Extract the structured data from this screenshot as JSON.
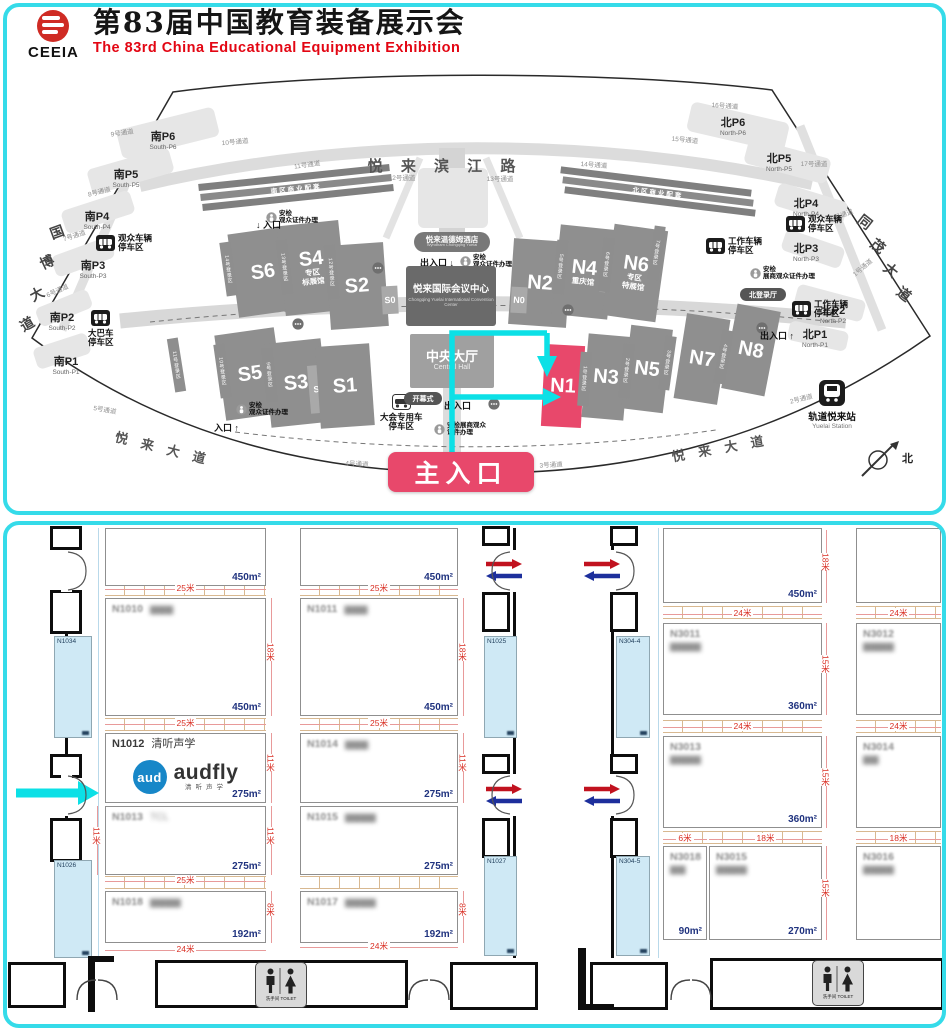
{
  "header": {
    "logo_text": "CEEIA",
    "title_cn": "第83届中国教育装备展示会",
    "title_en": "The 83rd China Educational Equipment Exhibition"
  },
  "colors": {
    "frame": "#35dbe9",
    "cyan": "#0ce0e6",
    "highlight": "#e8486b",
    "dim_red": "#d93025",
    "area_navy": "#20337f",
    "logo_blue": "#1787c8",
    "arrow_red": "#c1121f",
    "arrow_blue": "#1d2f9c",
    "hall_gray": "#8f8f8f"
  },
  "map": {
    "badge": "主入口",
    "north": "北",
    "roads_big": [
      {
        "t": "悦 来 滨 江 路",
        "x": 445,
        "y": 155,
        "fs": 15,
        "rot": 0,
        "ls": 7
      },
      {
        "t": "悦 来 大 道",
        "x": 163,
        "y": 438,
        "fs": 13,
        "rot": 14,
        "ls": 5
      },
      {
        "t": "悦 来 大 道",
        "x": 720,
        "y": 438,
        "fs": 13,
        "rot": -10,
        "ls": 5
      }
    ],
    "road_chars": [
      {
        "t": "国",
        "x": 50,
        "y": 222,
        "rot": -20
      },
      {
        "t": "博",
        "x": 40,
        "y": 252,
        "rot": -25
      },
      {
        "t": "大",
        "x": 30,
        "y": 284,
        "rot": -28
      },
      {
        "t": "道",
        "x": 20,
        "y": 314,
        "rot": -30
      },
      {
        "t": "同",
        "x": 858,
        "y": 212,
        "rot": 38
      },
      {
        "t": "茂",
        "x": 871,
        "y": 236,
        "rot": 38
      },
      {
        "t": "大",
        "x": 884,
        "y": 260,
        "rot": 38
      },
      {
        "t": "道",
        "x": 897,
        "y": 284,
        "rot": 38
      }
    ],
    "strips": [
      {
        "t": "南区商业配套",
        "x": 198,
        "y": 174,
        "rot": -6
      },
      {
        "t": "北区商业配套",
        "x": 560,
        "y": 178,
        "rot": 7
      }
    ],
    "halls": [
      {
        "t": "S6",
        "x": 263,
        "y": 272,
        "w": 60,
        "h": 84,
        "rot": -8
      },
      {
        "t": "S4",
        "sub": "专区|标展馆",
        "x": 312,
        "y": 268,
        "w": 62,
        "h": 90,
        "rot": -6
      },
      {
        "t": "S2",
        "x": 357,
        "y": 286,
        "w": 58,
        "h": 84,
        "rot": -4
      },
      {
        "t": "S0",
        "x": 390,
        "y": 300,
        "w": 16,
        "h": 28,
        "rot": -3,
        "small": true
      },
      {
        "t": "S5",
        "x": 250,
        "y": 374,
        "w": 60,
        "h": 86,
        "rot": -8
      },
      {
        "t": "S3",
        "x": 296,
        "y": 383,
        "w": 58,
        "h": 84,
        "rot": -6
      },
      {
        "t": "S9",
        "x": 319,
        "y": 389,
        "w": 20,
        "h": 48,
        "rot": -5,
        "small": true
      },
      {
        "t": "S1",
        "x": 345,
        "y": 386,
        "w": 54,
        "h": 82,
        "rot": -4
      },
      {
        "t": "N2",
        "x": 540,
        "y": 283,
        "w": 58,
        "h": 86,
        "rot": 4
      },
      {
        "t": "N4",
        "sub": "重庆馆",
        "x": 584,
        "y": 272,
        "w": 56,
        "h": 90,
        "rot": 6
      },
      {
        "t": "N9",
        "x": 611,
        "y": 268,
        "w": 18,
        "h": 50,
        "rot": 7,
        "small": true
      },
      {
        "t": "N6",
        "sub": "专区|特展馆",
        "x": 635,
        "y": 273,
        "w": 54,
        "h": 92,
        "rot": 8
      },
      {
        "t": "N0",
        "x": 519,
        "y": 300,
        "w": 16,
        "h": 26,
        "rot": 3,
        "small": true
      },
      {
        "t": "N1",
        "x": 563,
        "y": 386,
        "w": 40,
        "h": 82,
        "rot": 3,
        "red": true
      },
      {
        "t": "N3",
        "x": 606,
        "y": 377,
        "w": 42,
        "h": 84,
        "rot": 5
      },
      {
        "t": "N5",
        "x": 647,
        "y": 369,
        "w": 42,
        "h": 84,
        "rot": 7
      },
      {
        "t": "N7",
        "x": 702,
        "y": 359,
        "w": 44,
        "h": 86,
        "rot": 9
      },
      {
        "t": "N8",
        "x": 751,
        "y": 350,
        "w": 44,
        "h": 86,
        "rot": 11
      }
    ],
    "regs": [
      {
        "t": "14号登录区",
        "x": 228,
        "y": 242,
        "rot": -8
      },
      {
        "t": "13号登录区",
        "x": 284,
        "y": 240,
        "rot": -7
      },
      {
        "t": "12号登录区",
        "x": 331,
        "y": 245,
        "rot": -5
      },
      {
        "t": "11号登录区",
        "x": 176,
        "y": 338,
        "rot": -9
      },
      {
        "t": "10号登录区",
        "x": 222,
        "y": 344,
        "rot": -8
      },
      {
        "t": "9号登录区",
        "x": 269,
        "y": 348,
        "rot": -6
      },
      {
        "t": "5号登录区",
        "x": 560,
        "y": 240,
        "rot": 5
      },
      {
        "t": "6号登录区",
        "x": 606,
        "y": 238,
        "rot": 6
      },
      {
        "t": "7号登录区",
        "x": 656,
        "y": 226,
        "rot": 8
      },
      {
        "t": "1号登录区",
        "x": 584,
        "y": 352,
        "rot": 4
      },
      {
        "t": "2号登录区",
        "x": 626,
        "y": 344,
        "rot": 6
      },
      {
        "t": "3号登录区",
        "x": 667,
        "y": 336,
        "rot": 8
      },
      {
        "t": "4号登录区",
        "x": 723,
        "y": 330,
        "rot": 10
      }
    ],
    "parkings": [
      {
        "cn": "南P6",
        "en": "South-P6",
        "x": 163,
        "y": 132
      },
      {
        "cn": "南P5",
        "en": "South-P5",
        "x": 126,
        "y": 170
      },
      {
        "cn": "南P4",
        "en": "South-P4",
        "x": 97,
        "y": 212
      },
      {
        "cn": "南P3",
        "en": "South-P3",
        "x": 93,
        "y": 261
      },
      {
        "cn": "南P2",
        "en": "South-P2",
        "x": 62,
        "y": 313
      },
      {
        "cn": "南P1",
        "en": "South-P1",
        "x": 66,
        "y": 357
      },
      {
        "cn": "北P6",
        "en": "North-P6",
        "x": 733,
        "y": 118
      },
      {
        "cn": "北P5",
        "en": "North-P5",
        "x": 779,
        "y": 154
      },
      {
        "cn": "北P4",
        "en": "North-P4",
        "x": 806,
        "y": 199
      },
      {
        "cn": "北P3",
        "en": "North-P3",
        "x": 806,
        "y": 244
      },
      {
        "cn": "北P2",
        "en": "North-P2",
        "x": 833,
        "y": 306
      },
      {
        "cn": "北P1",
        "en": "North-P1",
        "x": 815,
        "y": 330
      }
    ],
    "channels": [
      {
        "t": "9号通道",
        "x": 120,
        "y": 127,
        "rot": -8
      },
      {
        "t": "10号通道",
        "x": 233,
        "y": 136,
        "rot": -5
      },
      {
        "t": "11号通道",
        "x": 305,
        "y": 159,
        "rot": -8
      },
      {
        "t": "8号通道",
        "x": 97,
        "y": 186,
        "rot": -14
      },
      {
        "t": "7号通道",
        "x": 72,
        "y": 230,
        "rot": -18
      },
      {
        "t": "6号通道",
        "x": 55,
        "y": 285,
        "rot": -24
      },
      {
        "t": "5号通道",
        "x": 103,
        "y": 404,
        "rot": 10
      },
      {
        "t": "4号通道",
        "x": 355,
        "y": 458,
        "rot": 3
      },
      {
        "t": "3号通道",
        "x": 549,
        "y": 459,
        "rot": -3
      },
      {
        "t": "2号通道",
        "x": 799,
        "y": 393,
        "rot": -14
      },
      {
        "t": "1号通道",
        "x": 860,
        "y": 262,
        "rot": -40
      },
      {
        "t": "12号通道",
        "x": 400,
        "y": 172,
        "rot": 0
      },
      {
        "t": "13号通道",
        "x": 498,
        "y": 173,
        "rot": 0
      },
      {
        "t": "14号通道",
        "x": 592,
        "y": 159,
        "rot": 4
      },
      {
        "t": "15号通道",
        "x": 683,
        "y": 134,
        "rot": 6
      },
      {
        "t": "16号通道",
        "x": 723,
        "y": 100,
        "rot": 4
      },
      {
        "t": "17号通道",
        "x": 812,
        "y": 158,
        "rot": 0
      },
      {
        "t": "18号通道",
        "x": 838,
        "y": 210,
        "rot": -20
      }
    ],
    "facilities": [
      {
        "type": "car",
        "l1": "观众车辆",
        "l2": "停车区",
        "x": 96,
        "y": 234,
        "layout": "row"
      },
      {
        "type": "car",
        "l1": "观众车辆",
        "l2": "停车区",
        "x": 786,
        "y": 215,
        "layout": "row"
      },
      {
        "type": "work",
        "l1": "工作车辆",
        "l2": "停车区",
        "x": 706,
        "y": 237,
        "layout": "row"
      },
      {
        "type": "work",
        "l1": "工作车辆",
        "l2": "停车区",
        "x": 792,
        "y": 300,
        "layout": "row"
      },
      {
        "type": "bus",
        "l1": "大巴车",
        "l2": "停车区",
        "x": 88,
        "y": 310,
        "layout": "col"
      },
      {
        "type": "car2",
        "l1": "大会专用车",
        "l2": "停车区",
        "x": 380,
        "y": 394,
        "layout": "col"
      }
    ],
    "security": [
      {
        "l1": "安检",
        "l2": "观众证件办理",
        "x": 266,
        "y": 210
      },
      {
        "l1": "安检",
        "l2": "观众证件办理",
        "x": 460,
        "y": 254
      },
      {
        "l1": "安检",
        "l2": "观众证件办理",
        "x": 236,
        "y": 402
      },
      {
        "l1": "安检展商观众",
        "l2": "证件办理",
        "x": 434,
        "y": 422
      },
      {
        "l1": "安检",
        "l2": "展商观众证件办理",
        "x": 750,
        "y": 266
      }
    ],
    "info_spots": [
      {
        "x": 292,
        "y": 318
      },
      {
        "x": 372,
        "y": 262
      },
      {
        "x": 562,
        "y": 304
      },
      {
        "x": 756,
        "y": 322
      },
      {
        "x": 488,
        "y": 398
      }
    ],
    "entrances": [
      {
        "t": "↓ 入口",
        "x": 256,
        "y": 218
      },
      {
        "t": "入口 ↑",
        "x": 214,
        "y": 421
      },
      {
        "t": "出入口 ↓",
        "x": 420,
        "y": 256
      },
      {
        "t": "出入口",
        "x": 444,
        "y": 399
      },
      {
        "t": "出入口 ↑",
        "x": 760,
        "y": 329
      }
    ],
    "pills": [
      {
        "t": "开幕式",
        "x": 404,
        "y": 392,
        "w": 38,
        "h": 13
      },
      {
        "t": "北登录厅",
        "x": 740,
        "y": 288,
        "w": 46,
        "h": 13
      }
    ],
    "hotel": {
      "t": "悦来温德姆酒店",
      "sub": "Wyndham Chongqing Yuelai",
      "x": 414,
      "y": 232,
      "w": 76,
      "h": 20
    },
    "convention": {
      "t": "悦来国际会议中心",
      "sub": "Chongqing Yuelai International Convention Center",
      "x": 406,
      "y": 266,
      "w": 90,
      "h": 60
    },
    "central_hall": {
      "t": "中央大厅",
      "sub": "Central Hall",
      "x": 410,
      "y": 334,
      "w": 84,
      "h": 54
    },
    "station": {
      "t": "轨道悦来站",
      "sub": "Yuelai Station",
      "x": 832,
      "y": 380
    }
  },
  "plan": {
    "toilet": "洗手间 TOILET",
    "audfly": {
      "circle": "aud",
      "brand": "audfly",
      "sub": "清听声学"
    },
    "booths": [
      {
        "id": "",
        "name": "",
        "area": "450m²",
        "x": 105,
        "y": 528,
        "w": 161,
        "h": 58
      },
      {
        "id": "N1010",
        "name": "▆▆▆",
        "area": "450m²",
        "x": 105,
        "y": 598,
        "w": 161,
        "h": 118,
        "blur": true
      },
      {
        "id": "N1012",
        "name": "清听声学",
        "area": "275m²",
        "x": 105,
        "y": 733,
        "w": 161,
        "h": 70,
        "logo": true
      },
      {
        "id": "N1013",
        "name": "TCL",
        "area": "275m²",
        "x": 105,
        "y": 806,
        "w": 161,
        "h": 69,
        "blur": true
      },
      {
        "id": "N1018",
        "name": "▆▆▆▆",
        "area": "192m²",
        "x": 105,
        "y": 891,
        "w": 161,
        "h": 52,
        "blur": true
      },
      {
        "id": "",
        "name": "",
        "area": "450m²",
        "x": 300,
        "y": 528,
        "w": 158,
        "h": 58
      },
      {
        "id": "N1011",
        "name": "▆▆▆",
        "area": "450m²",
        "x": 300,
        "y": 598,
        "w": 158,
        "h": 118,
        "blur": true
      },
      {
        "id": "N1014",
        "name": "▆▆▆",
        "area": "275m²",
        "x": 300,
        "y": 733,
        "w": 158,
        "h": 70,
        "blur": true
      },
      {
        "id": "N1015",
        "name": "▆▆▆▆",
        "area": "275m²",
        "x": 300,
        "y": 806,
        "w": 158,
        "h": 69,
        "blur": true
      },
      {
        "id": "N1017",
        "name": "▆▆▆▆",
        "area": "192m²",
        "x": 300,
        "y": 891,
        "w": 158,
        "h": 52,
        "blur": true
      },
      {
        "id": "",
        "name": "",
        "area": "450m²",
        "x": 663,
        "y": 528,
        "w": 159,
        "h": 75
      },
      {
        "id": "N3011",
        "name": "▆▆▆▆",
        "area": "360m²",
        "x": 663,
        "y": 623,
        "w": 159,
        "h": 92,
        "blur": true,
        "two": true
      },
      {
        "id": "N3013",
        "name": "▆▆▆▆",
        "area": "360m²",
        "x": 663,
        "y": 736,
        "w": 159,
        "h": 92,
        "blur": true,
        "two": true
      },
      {
        "id": "N3018",
        "name": "▆▆",
        "area": "90m²",
        "x": 663,
        "y": 846,
        "w": 44,
        "h": 94,
        "blur": true,
        "two": true
      },
      {
        "id": "N3015",
        "name": "▆▆▆▆",
        "area": "270m²",
        "x": 709,
        "y": 846,
        "w": 113,
        "h": 94,
        "blur": true,
        "two": true
      },
      {
        "id": "",
        "name": "",
        "area": "",
        "x": 856,
        "y": 528,
        "w": 85,
        "h": 75
      },
      {
        "id": "N3012",
        "name": "▆▆▆▆",
        "area": "",
        "x": 856,
        "y": 623,
        "w": 85,
        "h": 92,
        "blur": true,
        "two": true
      },
      {
        "id": "N3014",
        "name": "▆▆",
        "area": "",
        "x": 856,
        "y": 736,
        "w": 85,
        "h": 92,
        "blur": true,
        "two": true
      },
      {
        "id": "N3016",
        "name": "▆▆▆▆",
        "area": "",
        "x": 856,
        "y": 846,
        "w": 85,
        "h": 94,
        "blur": true,
        "two": true
      }
    ],
    "dims_h": [
      {
        "t": "25米",
        "x": 105,
        "y": 589,
        "w": 161
      },
      {
        "t": "25米",
        "x": 300,
        "y": 589,
        "w": 158
      },
      {
        "t": "25米",
        "x": 105,
        "y": 724,
        "w": 161
      },
      {
        "t": "25米",
        "x": 300,
        "y": 724,
        "w": 158
      },
      {
        "t": "25米",
        "x": 105,
        "y": 881,
        "w": 161
      },
      {
        "t": "24米",
        "x": 105,
        "y": 950,
        "w": 161
      },
      {
        "t": "24米",
        "x": 300,
        "y": 947,
        "w": 158
      },
      {
        "t": "24米",
        "x": 663,
        "y": 614,
        "w": 159
      },
      {
        "t": "24米",
        "x": 856,
        "y": 614,
        "w": 85
      },
      {
        "t": "24米",
        "x": 663,
        "y": 727,
        "w": 159
      },
      {
        "t": "24米",
        "x": 856,
        "y": 727,
        "w": 85
      },
      {
        "t": "6米",
        "x": 663,
        "y": 839,
        "w": 44
      },
      {
        "t": "18米",
        "x": 709,
        "y": 839,
        "w": 113
      },
      {
        "t": "18米",
        "x": 856,
        "y": 839,
        "w": 85
      }
    ],
    "dims_v": [
      {
        "t": "18米",
        "x": 271,
        "y": 598,
        "h": 118
      },
      {
        "t": "18米",
        "x": 463,
        "y": 598,
        "h": 118
      },
      {
        "t": "11米",
        "x": 271,
        "y": 733,
        "h": 70
      },
      {
        "t": "11米",
        "x": 463,
        "y": 733,
        "h": 70
      },
      {
        "t": "11米",
        "x": 97,
        "y": 806,
        "h": 69
      },
      {
        "t": "11米",
        "x": 271,
        "y": 806,
        "h": 69
      },
      {
        "t": "8米",
        "x": 271,
        "y": 891,
        "h": 52
      },
      {
        "t": "8米",
        "x": 463,
        "y": 891,
        "h": 52
      },
      {
        "t": "18米",
        "x": 826,
        "y": 530,
        "h": 73
      },
      {
        "t": "15米",
        "x": 826,
        "y": 623,
        "h": 92
      },
      {
        "t": "15米",
        "x": 826,
        "y": 736,
        "h": 92
      },
      {
        "t": "15米",
        "x": 826,
        "y": 846,
        "h": 94
      }
    ],
    "columns": [
      {
        "t": "N1034",
        "x": 54,
        "y": 636,
        "w": 38,
        "h": 102
      },
      {
        "t": "N1026",
        "x": 54,
        "y": 860,
        "w": 38,
        "h": 98
      },
      {
        "t": "N1025",
        "x": 484,
        "y": 636,
        "w": 33,
        "h": 102
      },
      {
        "t": "N1027",
        "x": 484,
        "y": 856,
        "w": 33,
        "h": 100
      },
      {
        "t": "N304-4",
        "x": 616,
        "y": 636,
        "w": 34,
        "h": 102
      },
      {
        "t": "N304-5",
        "x": 616,
        "y": 856,
        "w": 34,
        "h": 100
      }
    ]
  }
}
